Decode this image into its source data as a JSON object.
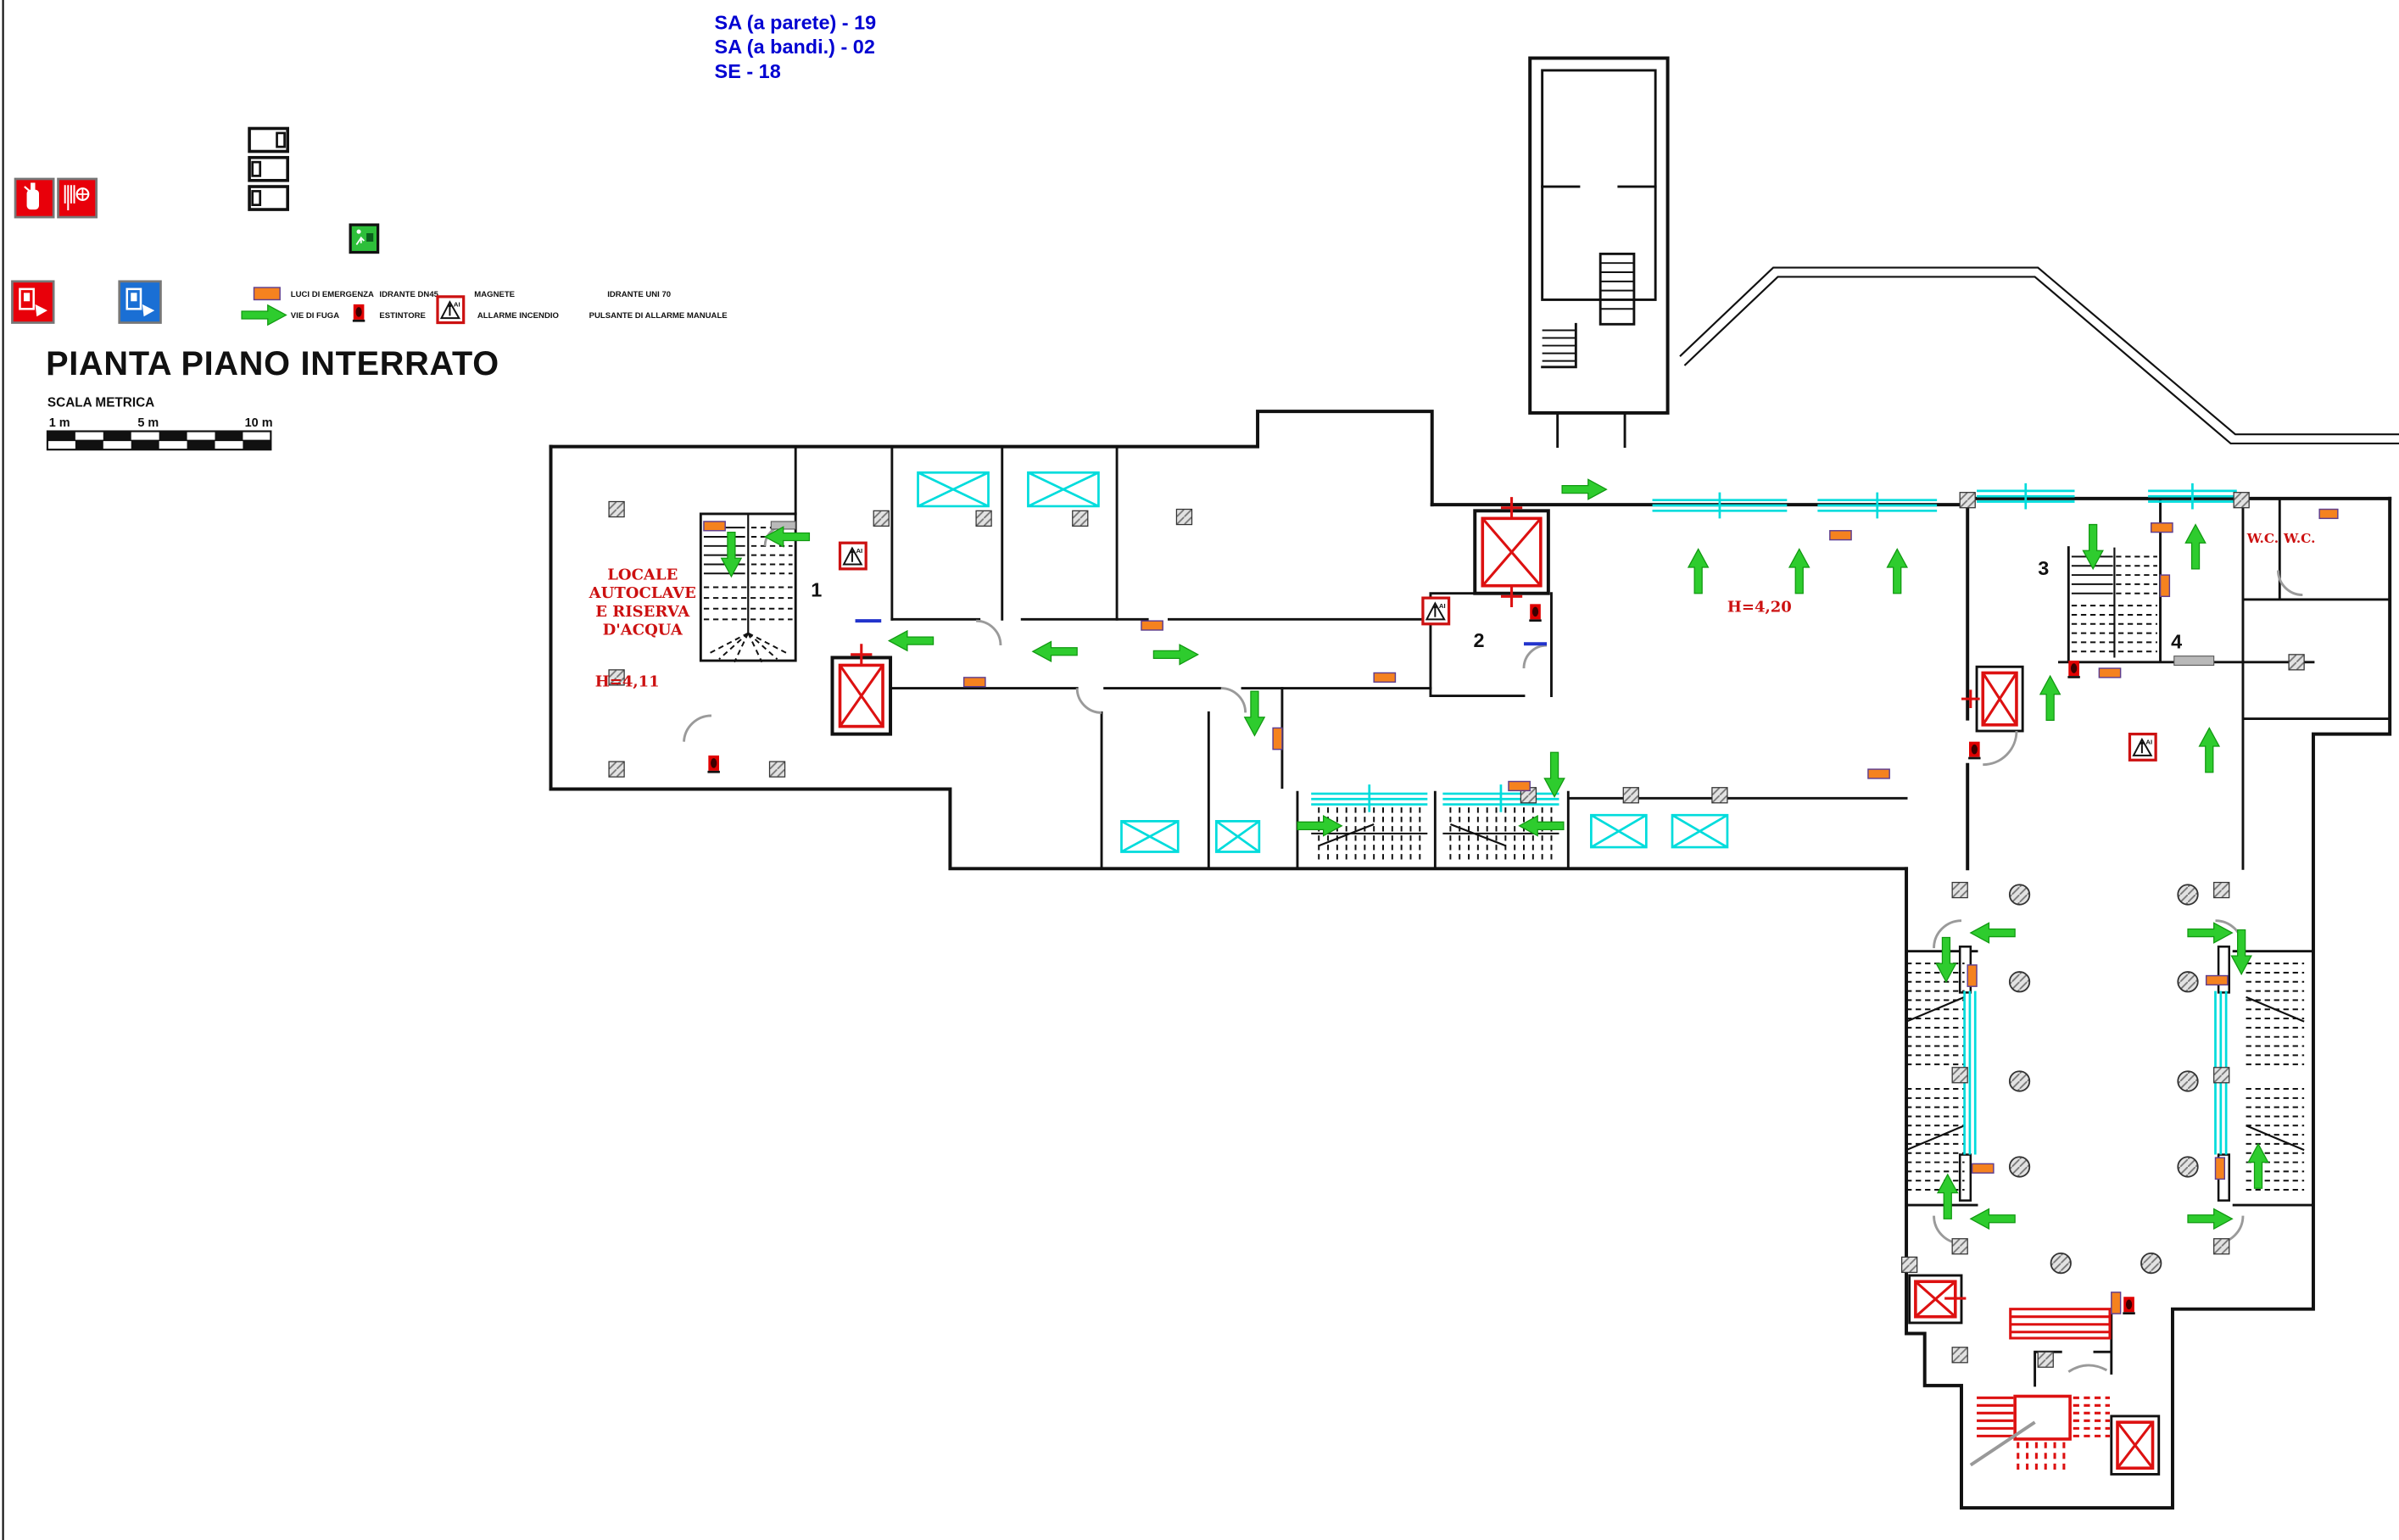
{
  "header_notes": {
    "line1": "SA (a parete) - 19",
    "line2": "SA (a bandi.) - 02",
    "line3": "SE - 18"
  },
  "title": "PIANTA PIANO INTERRATO",
  "scale_bar": {
    "label": "SCALA METRICA",
    "ticks": [
      "1 m",
      "5 m",
      "10 m"
    ]
  },
  "legend": {
    "luci_di_emergenza": "LUCI DI EMERGENZA",
    "vie_di_fuga": "VIE DI FUGA",
    "idrante_dn45": "IDRANTE DN45",
    "estintore": "ESTINTORE",
    "magnete": "MAGNETE",
    "allarme_incendio": "ALLARME INCENDIO",
    "idrante_uni70": "IDRANTE UNI 70",
    "pulsante": "PULSANTE DI ALLARME MANUALE"
  },
  "plan_labels": {
    "room_autoclave_line1": "LOCALE",
    "room_autoclave_line2": "AUTOCLAVE",
    "room_autoclave_line3": "E RISERVA",
    "room_autoclave_line4": "D'ACQUA",
    "height_left": "H=4,11",
    "height_center": "H=4,20",
    "wc_left": "W.C.",
    "wc_right": "W.C.",
    "stair_number_1": "1",
    "stair_number_2": "2",
    "stair_number_3": "3",
    "stair_number_4": "4",
    "fire_alarm_abbr": "AI"
  },
  "colors": {
    "wall": "#111111",
    "plan_red": "#dd1111",
    "escape_green": "#2ecc2e",
    "emergency_light_orange": "#f5821f",
    "window_cyan": "#00dcdc",
    "note_blue": "#0000d2",
    "sign_red": "#e8000a",
    "sign_blue": "#1a6fd4",
    "exit_sign_green": "#2ebf3a",
    "door_gray": "#9a9a9a"
  }
}
